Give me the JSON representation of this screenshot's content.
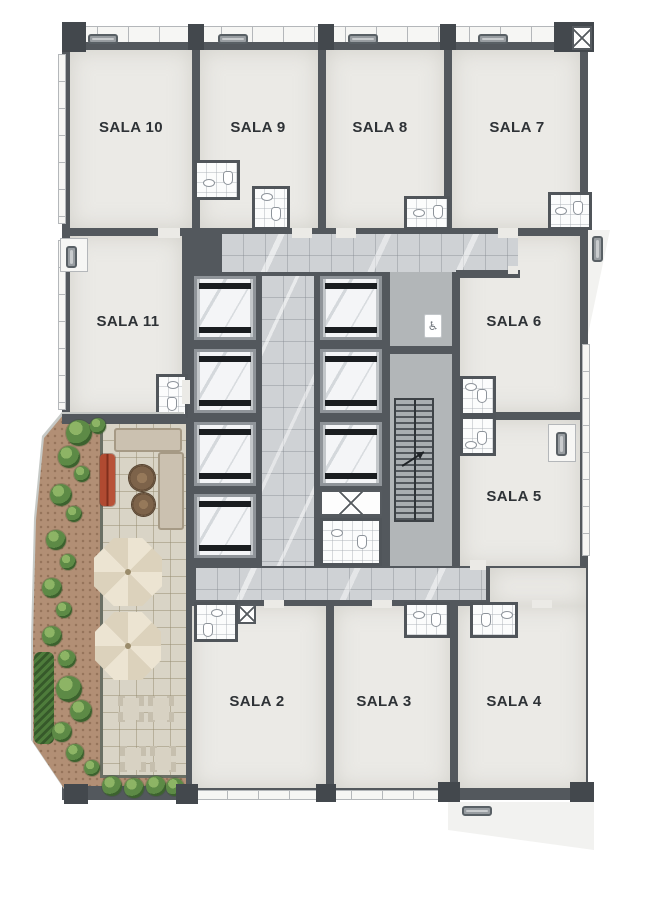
{
  "plan": {
    "type": "residential-floor-plan",
    "rooms": [
      {
        "id": "sala-10",
        "label": "SALA 10"
      },
      {
        "id": "sala-9",
        "label": "SALA 9"
      },
      {
        "id": "sala-8",
        "label": "SALA 8"
      },
      {
        "id": "sala-7",
        "label": "SALA 7"
      },
      {
        "id": "sala-11",
        "label": "SALA 11"
      },
      {
        "id": "sala-6",
        "label": "SALA 6"
      },
      {
        "id": "sala-5",
        "label": "SALA 5"
      },
      {
        "id": "sala-2",
        "label": "SALA 2"
      },
      {
        "id": "sala-3",
        "label": "SALA 3"
      },
      {
        "id": "sala-4",
        "label": "SALA 4"
      }
    ],
    "core": {
      "elevator_count": 7,
      "accessible_wc_symbol": "♿"
    },
    "terrace_features": [
      "garden",
      "lounge-sofa",
      "coffee-tables",
      "chaise-longue",
      "umbrellas",
      "dining-tables",
      "hedge"
    ],
    "colors": {
      "wall": "#53585d",
      "room_fill": "#ebeae6",
      "corridor_marble": "#cfd2d5",
      "core_gray": "#b2b6b8",
      "terrace_tile": "#d9d4c6",
      "mulch": "#b28f75",
      "garden_green": "#4e7c3b",
      "chaise_red": "#b04a31",
      "umbrella_cream": "#ece4d2"
    }
  }
}
